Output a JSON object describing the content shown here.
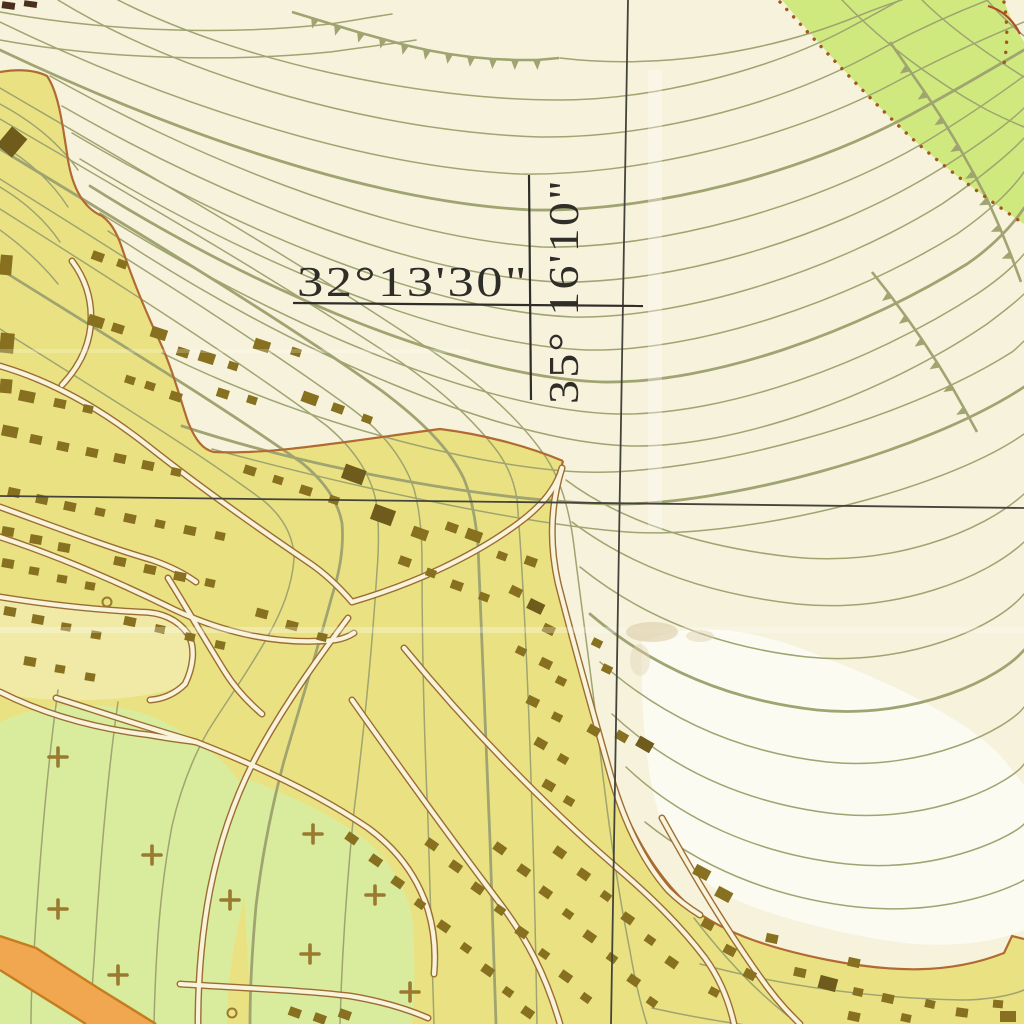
{
  "coordinates": {
    "latitude_label": "32°13'30\"",
    "longitude_label": "35° 16'10\""
  },
  "palette": {
    "background": "#f6f2dc",
    "bright_patch": "#fcfbf1",
    "builtup": "#eae282",
    "builtup_pale": "#f0eaa6",
    "orchard_green": "#d9ec9d",
    "grove_green": "#cfe97e",
    "building": "#87701f",
    "building_dark": "#6f5c1c",
    "road_fill": "#f8f3da",
    "road_casing": "#9c6d33",
    "boundary": "#b06a32",
    "orange_road": "#f0a74f",
    "orange_road_edge": "#c67d22",
    "contour": "#9fa470",
    "grid_line": "#45443c",
    "label_text": "#2e2d27",
    "dotted_boundary": "#a4571e",
    "plus_symbol": "#9a7930",
    "corner_mark": "#4a2f1d"
  }
}
